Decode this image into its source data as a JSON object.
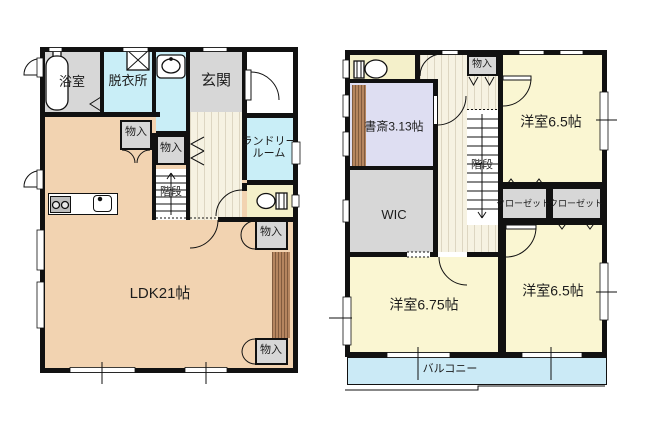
{
  "floor1": {
    "bath": "浴室",
    "dressing": "脱衣所",
    "entrance": "玄関",
    "storage_a": "物入",
    "storage_b": "物入",
    "stairs": "階段",
    "laundry": "ランドリールーム",
    "ldk": "LDK21帖",
    "storage_c": "物入",
    "storage_d": "物入"
  },
  "floor2": {
    "storage": "物入",
    "bedroom_ne": "洋室6.5帖",
    "study": "書斎3.13帖",
    "stairs": "階段",
    "wic": "WIC",
    "closet_a": "クローゼット",
    "closet_b": "クローゼット",
    "bedroom_sw": "洋室6.75帖",
    "bedroom_se": "洋室6.5帖",
    "balcony": "バルコニー"
  },
  "colors": {
    "wall": "#111111",
    "ldk_floor": "#f2d3b1",
    "wet_area_floor": "#c9eef7",
    "entrance_gray": "#d7d7d7",
    "hall_floor": "#f6f2e2",
    "bedroom_yellow": "#faf6d2",
    "toilet_yellow": "#f4f0ca",
    "study_lavender": "#dedef2",
    "balcony_blue": "#cbeaf6",
    "wood_strip": "#b5855f"
  }
}
